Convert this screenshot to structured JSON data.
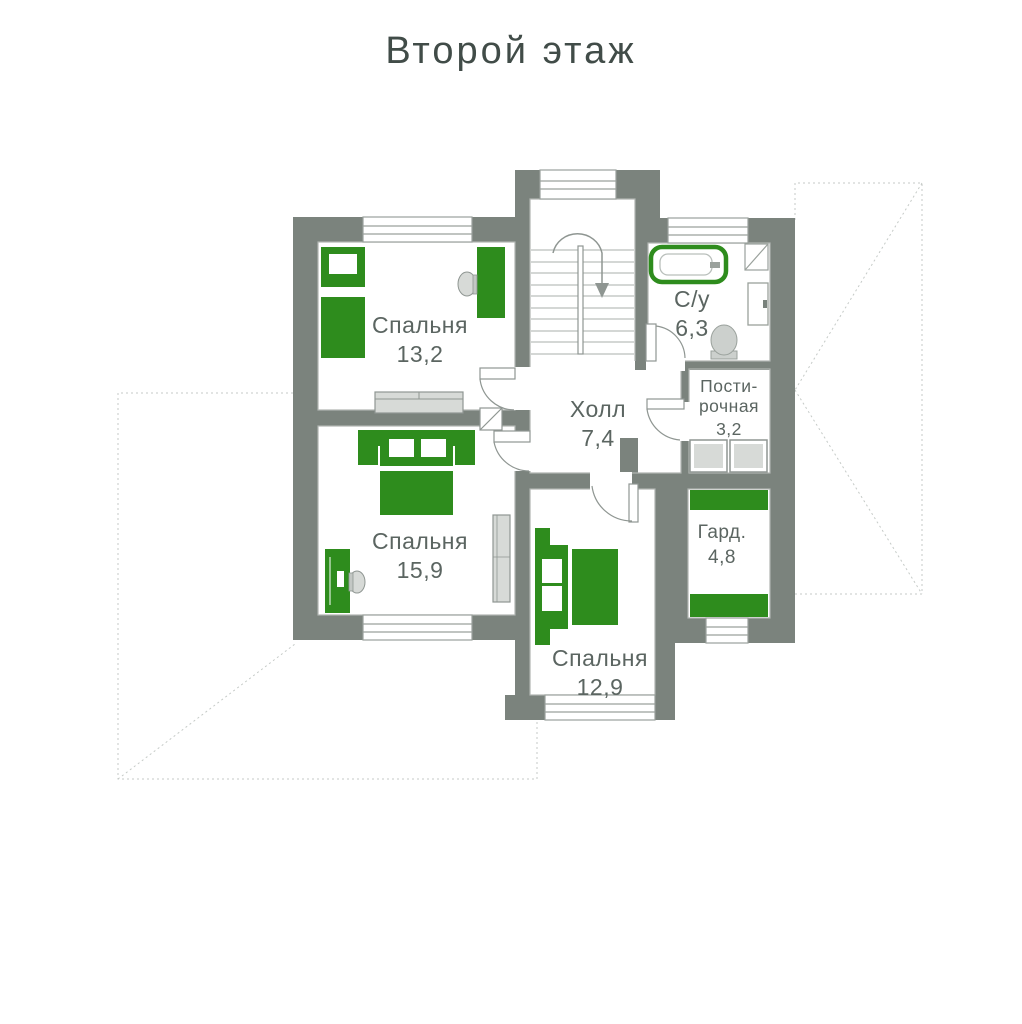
{
  "title": "Второй этаж",
  "colors": {
    "wall": "#7b837d",
    "accent_green": "#2e8c1d",
    "furniture_gray": "#d7dad7",
    "outline": "#9aa19c",
    "label_text": "#5b6561",
    "title_text": "#414c48",
    "roof_dash": "#c5cac7"
  },
  "rooms": [
    {
      "id": "bedroom-13-2",
      "name": "Спальня",
      "area": "13,2"
    },
    {
      "id": "bedroom-15-9",
      "name": "Спальня",
      "area": "15,9"
    },
    {
      "id": "bedroom-12-9",
      "name": "Спальня",
      "area": "12,9"
    },
    {
      "id": "hall",
      "name": "Холл",
      "area": "7,4"
    },
    {
      "id": "bathroom",
      "name": "С/у",
      "area": "6,3"
    },
    {
      "id": "laundry",
      "name": "Пости-рочная",
      "area": "3,2"
    },
    {
      "id": "wardrobe",
      "name": "Гард.",
      "area": "4,8"
    }
  ]
}
